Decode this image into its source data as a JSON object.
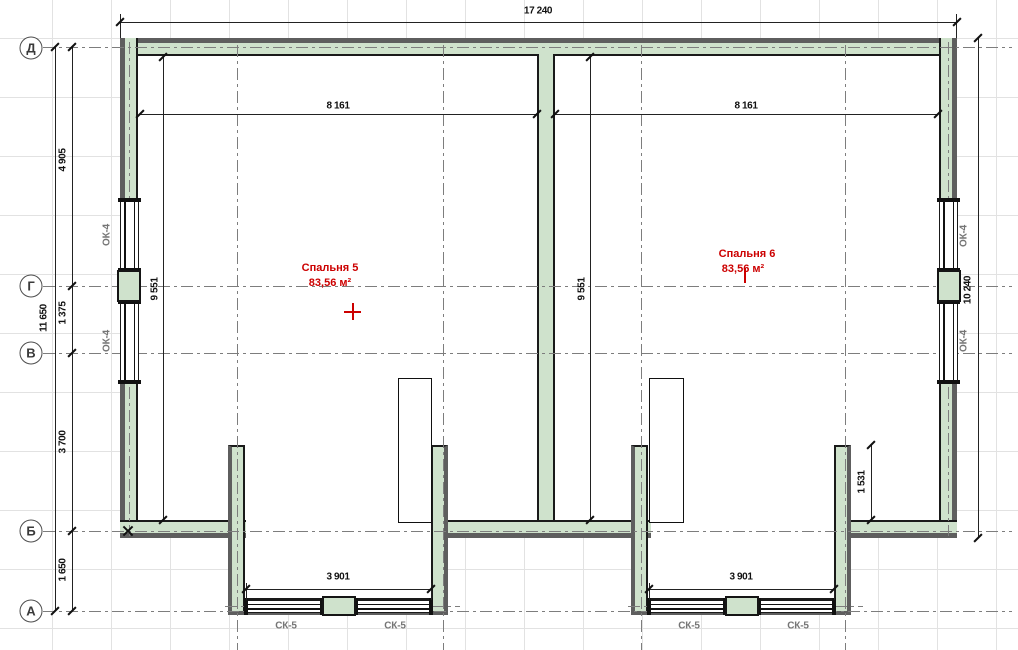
{
  "grid_axes": {
    "rows": [
      {
        "label": "Д"
      },
      {
        "label": "Г"
      },
      {
        "label": "В"
      },
      {
        "label": "Б"
      },
      {
        "label": "А"
      }
    ]
  },
  "dimensions": {
    "overall_width": "17 240",
    "interior_width": "8 161",
    "interior_height": "9 551",
    "overall_height_right": "10 240",
    "overall_height_left": "11 650",
    "span_d_g": "4 905",
    "span_g_v": "1 375",
    "span_v_b": "3 700",
    "span_b_a": "1 650",
    "bay_width": "3 901",
    "bay_wall_length": "1 531"
  },
  "window_tags": {
    "side": "ОК-4",
    "bay": "СК-5"
  },
  "rooms": [
    {
      "name": "Спальня 5",
      "area": "83,56 м²"
    },
    {
      "name": "Спальня 6",
      "area": "83,56 м²"
    }
  ],
  "colors": {
    "wall_fill": "#cfe2cc",
    "wall_edge": "#5e5e5e",
    "room_label": "#cc0000",
    "tag_gray": "#757575"
  }
}
